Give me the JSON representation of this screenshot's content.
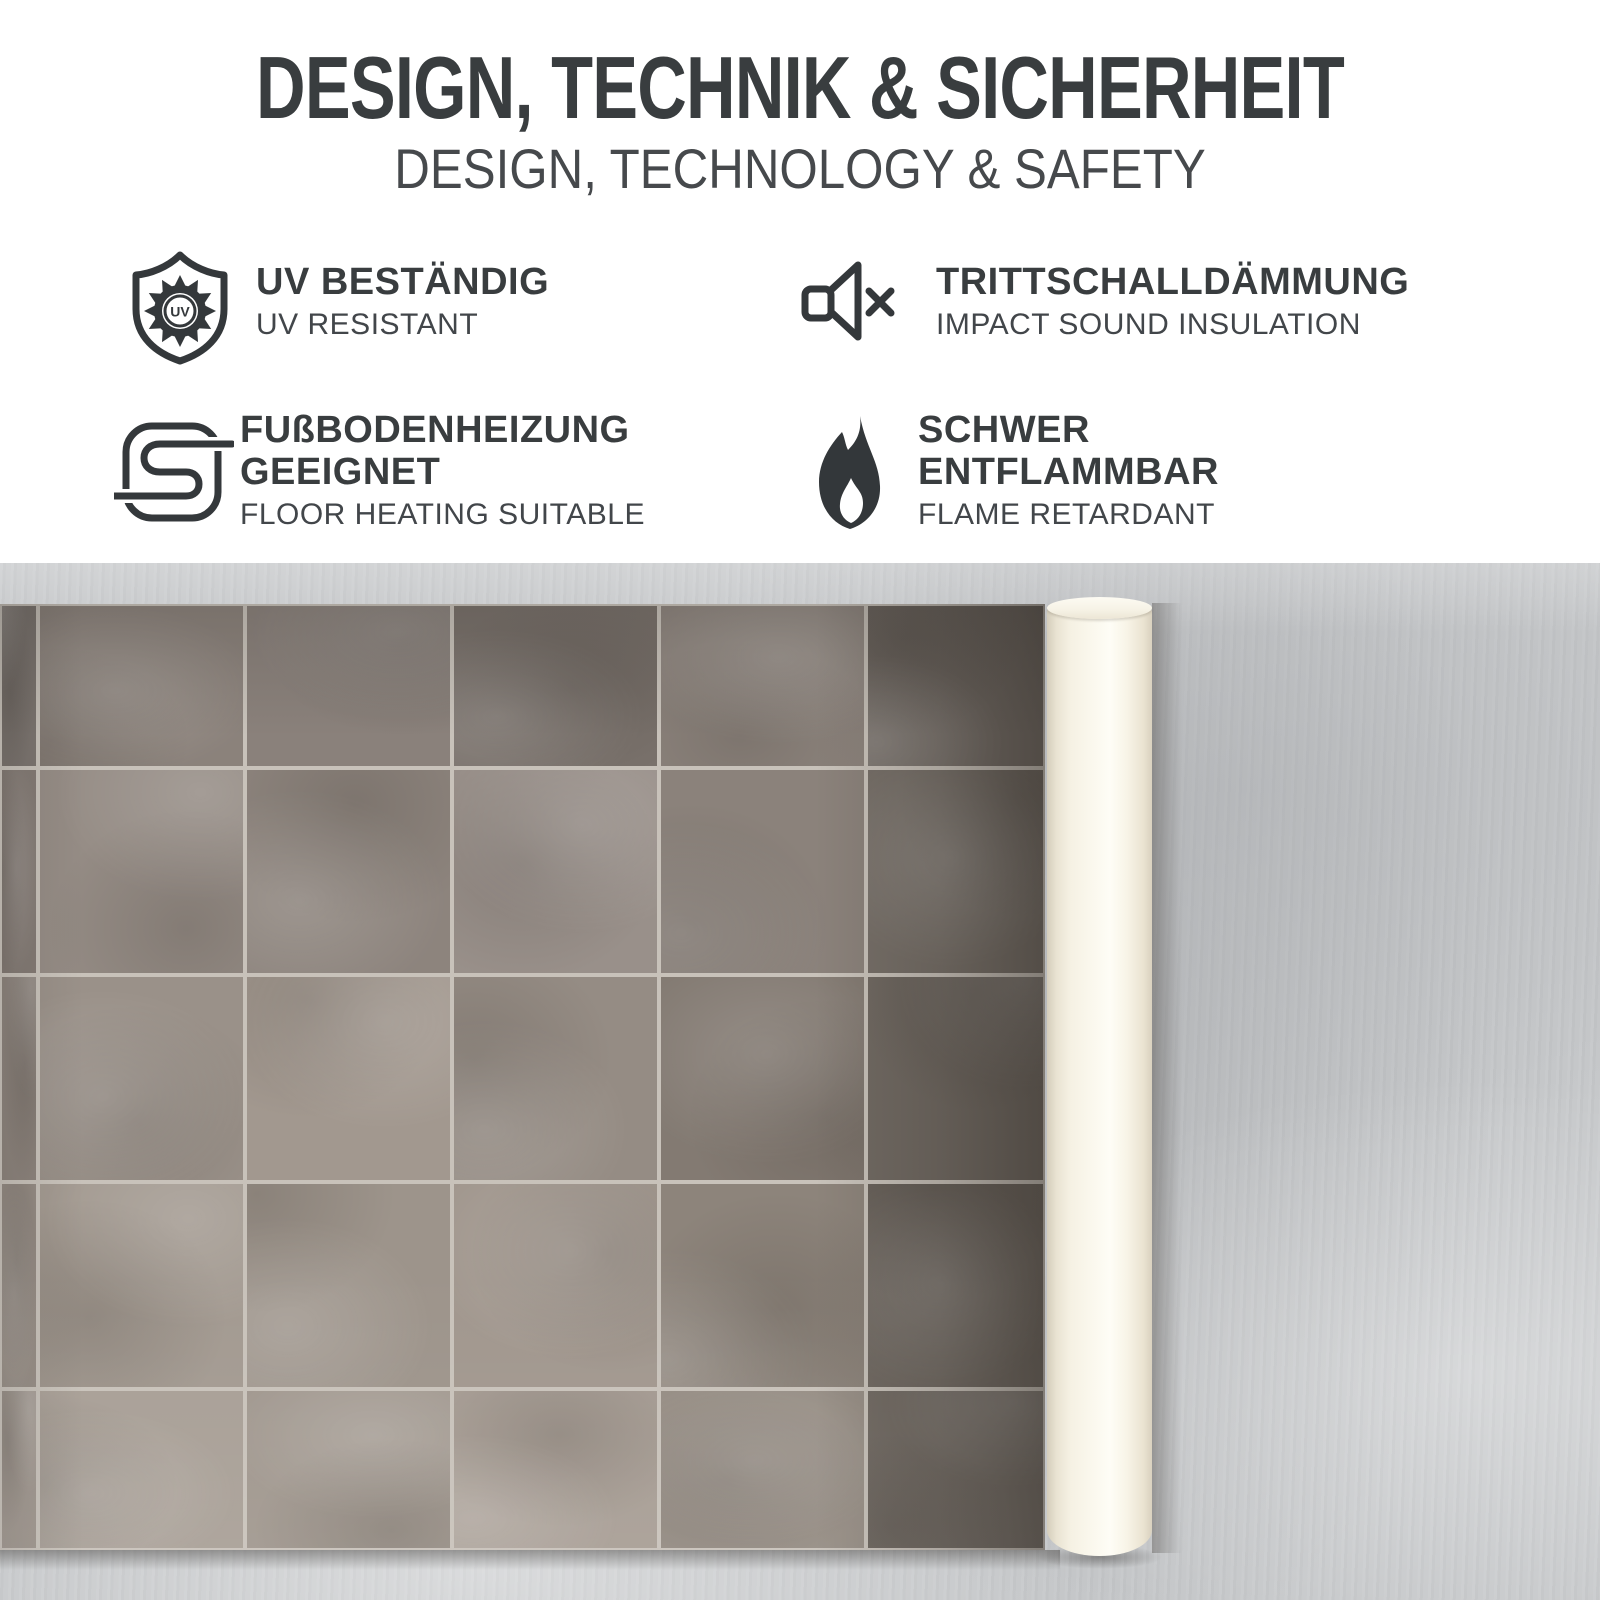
{
  "header": {
    "title": "DESIGN, TECHNIK & SICHERHEIT",
    "subtitle": "DESIGN, TECHNOLOGY & SAFETY"
  },
  "features": [
    {
      "icon": "uv-shield-icon",
      "icon_label": "UV",
      "title": "UV BESTÄNDIG",
      "subtitle": "UV RESISTANT"
    },
    {
      "icon": "speaker-muted-icon",
      "title": "TRITTSCHALLDÄMMUNG",
      "subtitle": "IMPACT SOUND INSULATION"
    },
    {
      "icon": "floor-heating-icon",
      "title": "FUßBODENHEIZUNG GEEIGNET",
      "subtitle": "FLOOR HEATING SUITABLE"
    },
    {
      "icon": "flame-icon",
      "title": "SCHWER ENTFLAMMBAR",
      "subtitle": "FLAME RETARDANT"
    }
  ],
  "colors": {
    "text_dark": "#393d3f",
    "text_medium": "#46494c",
    "icon_stroke": "#34383b",
    "background_top": "#ffffff",
    "concrete": "#c6c8ca",
    "grout": "#c8c2ba",
    "roll_cream": "#f8f4e7",
    "roll_edge": "#d4cdbb"
  },
  "photo": {
    "sheet": {
      "col_edges": [
        0,
        38,
        245,
        452,
        659,
        866,
        1045
      ],
      "row_edges": [
        0,
        164,
        371,
        578,
        785,
        946
      ],
      "tile_colors": [
        [
          "#7b746f",
          "#8b827b",
          "#8a817b",
          "#79716b",
          "#8d847d",
          "#726b65"
        ],
        [
          "#837a74",
          "#958c85",
          "#8d847d",
          "#99908a",
          "#8b827b",
          "#766f68"
        ],
        [
          "#8c837c",
          "#9a9189",
          "#a2988f",
          "#958c84",
          "#837a72",
          "#716a63"
        ],
        [
          "#958c84",
          "#a39a91",
          "#9d948b",
          "#a1978e",
          "#8d847b",
          "#6e6760"
        ],
        [
          "#9d948c",
          "#a89f96",
          "#a0978e",
          "#a79d94",
          "#958c83",
          "#6f6861"
        ]
      ]
    }
  }
}
